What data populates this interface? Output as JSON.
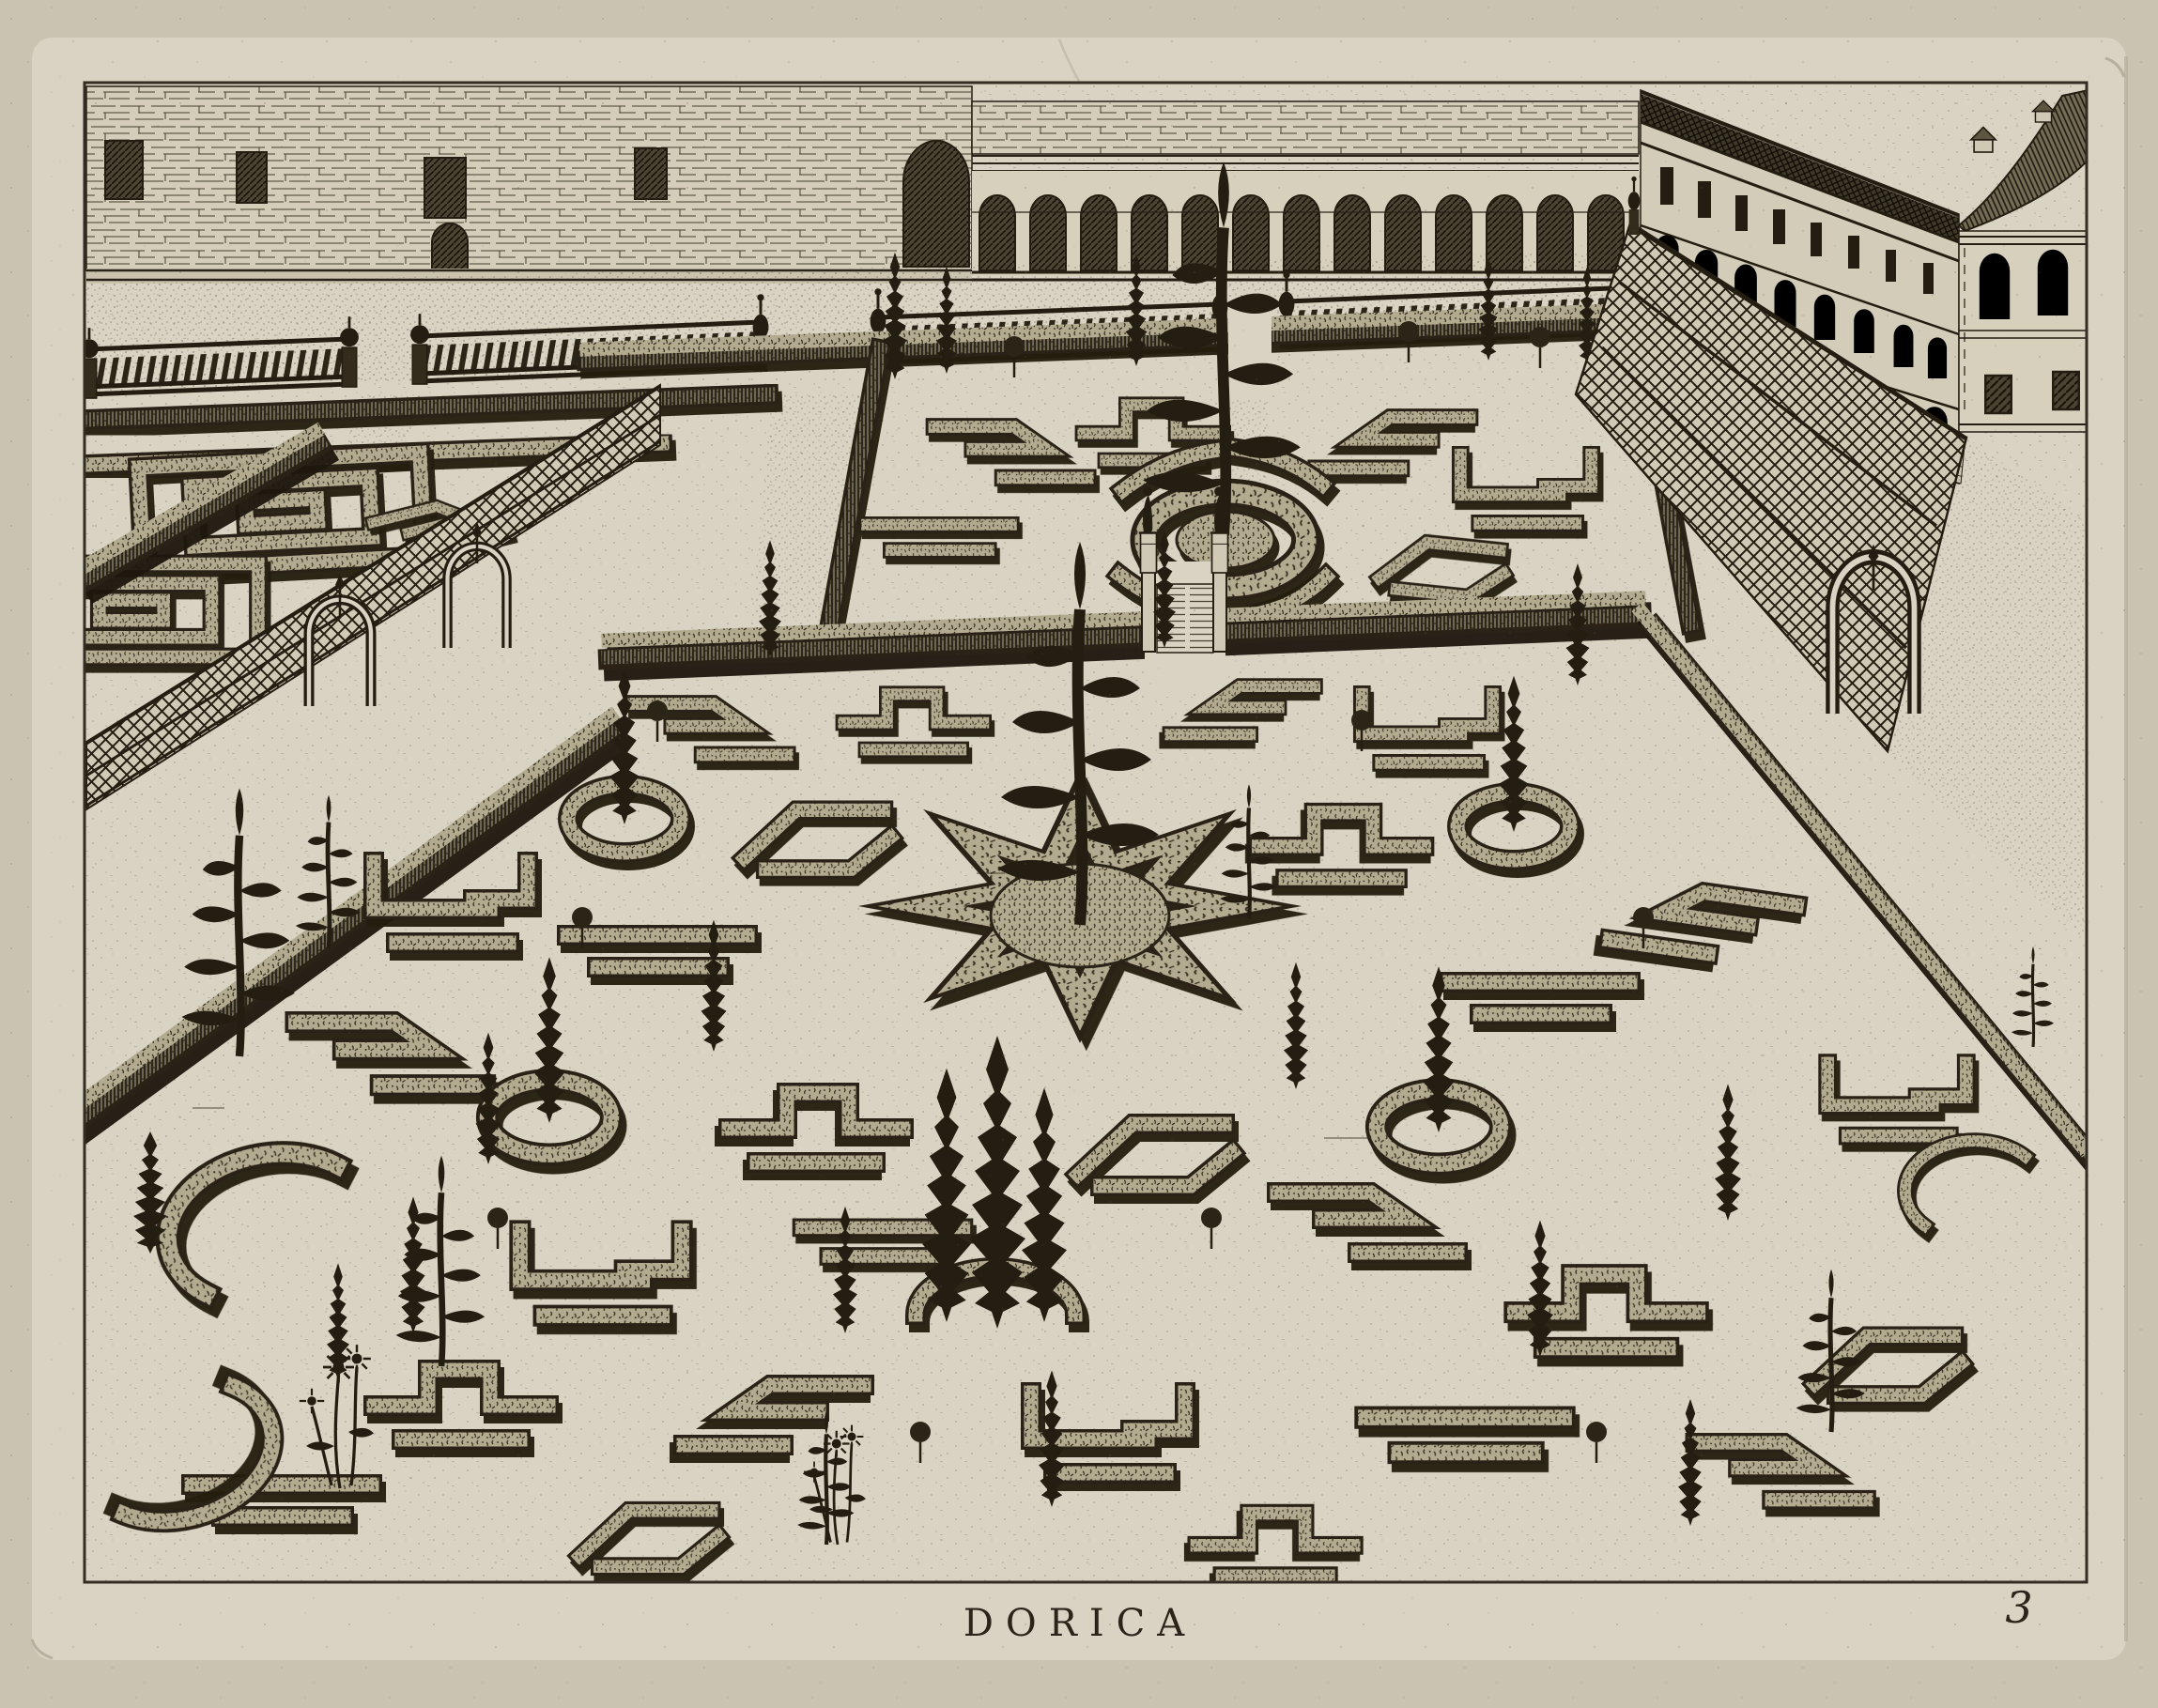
{
  "artwork": {
    "caption": "DORICA",
    "plate_number": "3",
    "type": "copperplate-engraving",
    "subject": "bird's-eye view of a Renaissance knot-garden courtyard: masonry wall with arcade, palace wing with pavilion, balustraded terrace, trellis fences with arched gates, clipped hedge parterres and slender trees",
    "palette": {
      "paper_margin": "#c9c4b2",
      "paper_plate": "#d8d3c2",
      "ink_dark": "#241e12",
      "ink_mid": "#4a4434",
      "hedge_top": "#b3ab90",
      "hedge_face": "#6e6650"
    }
  }
}
